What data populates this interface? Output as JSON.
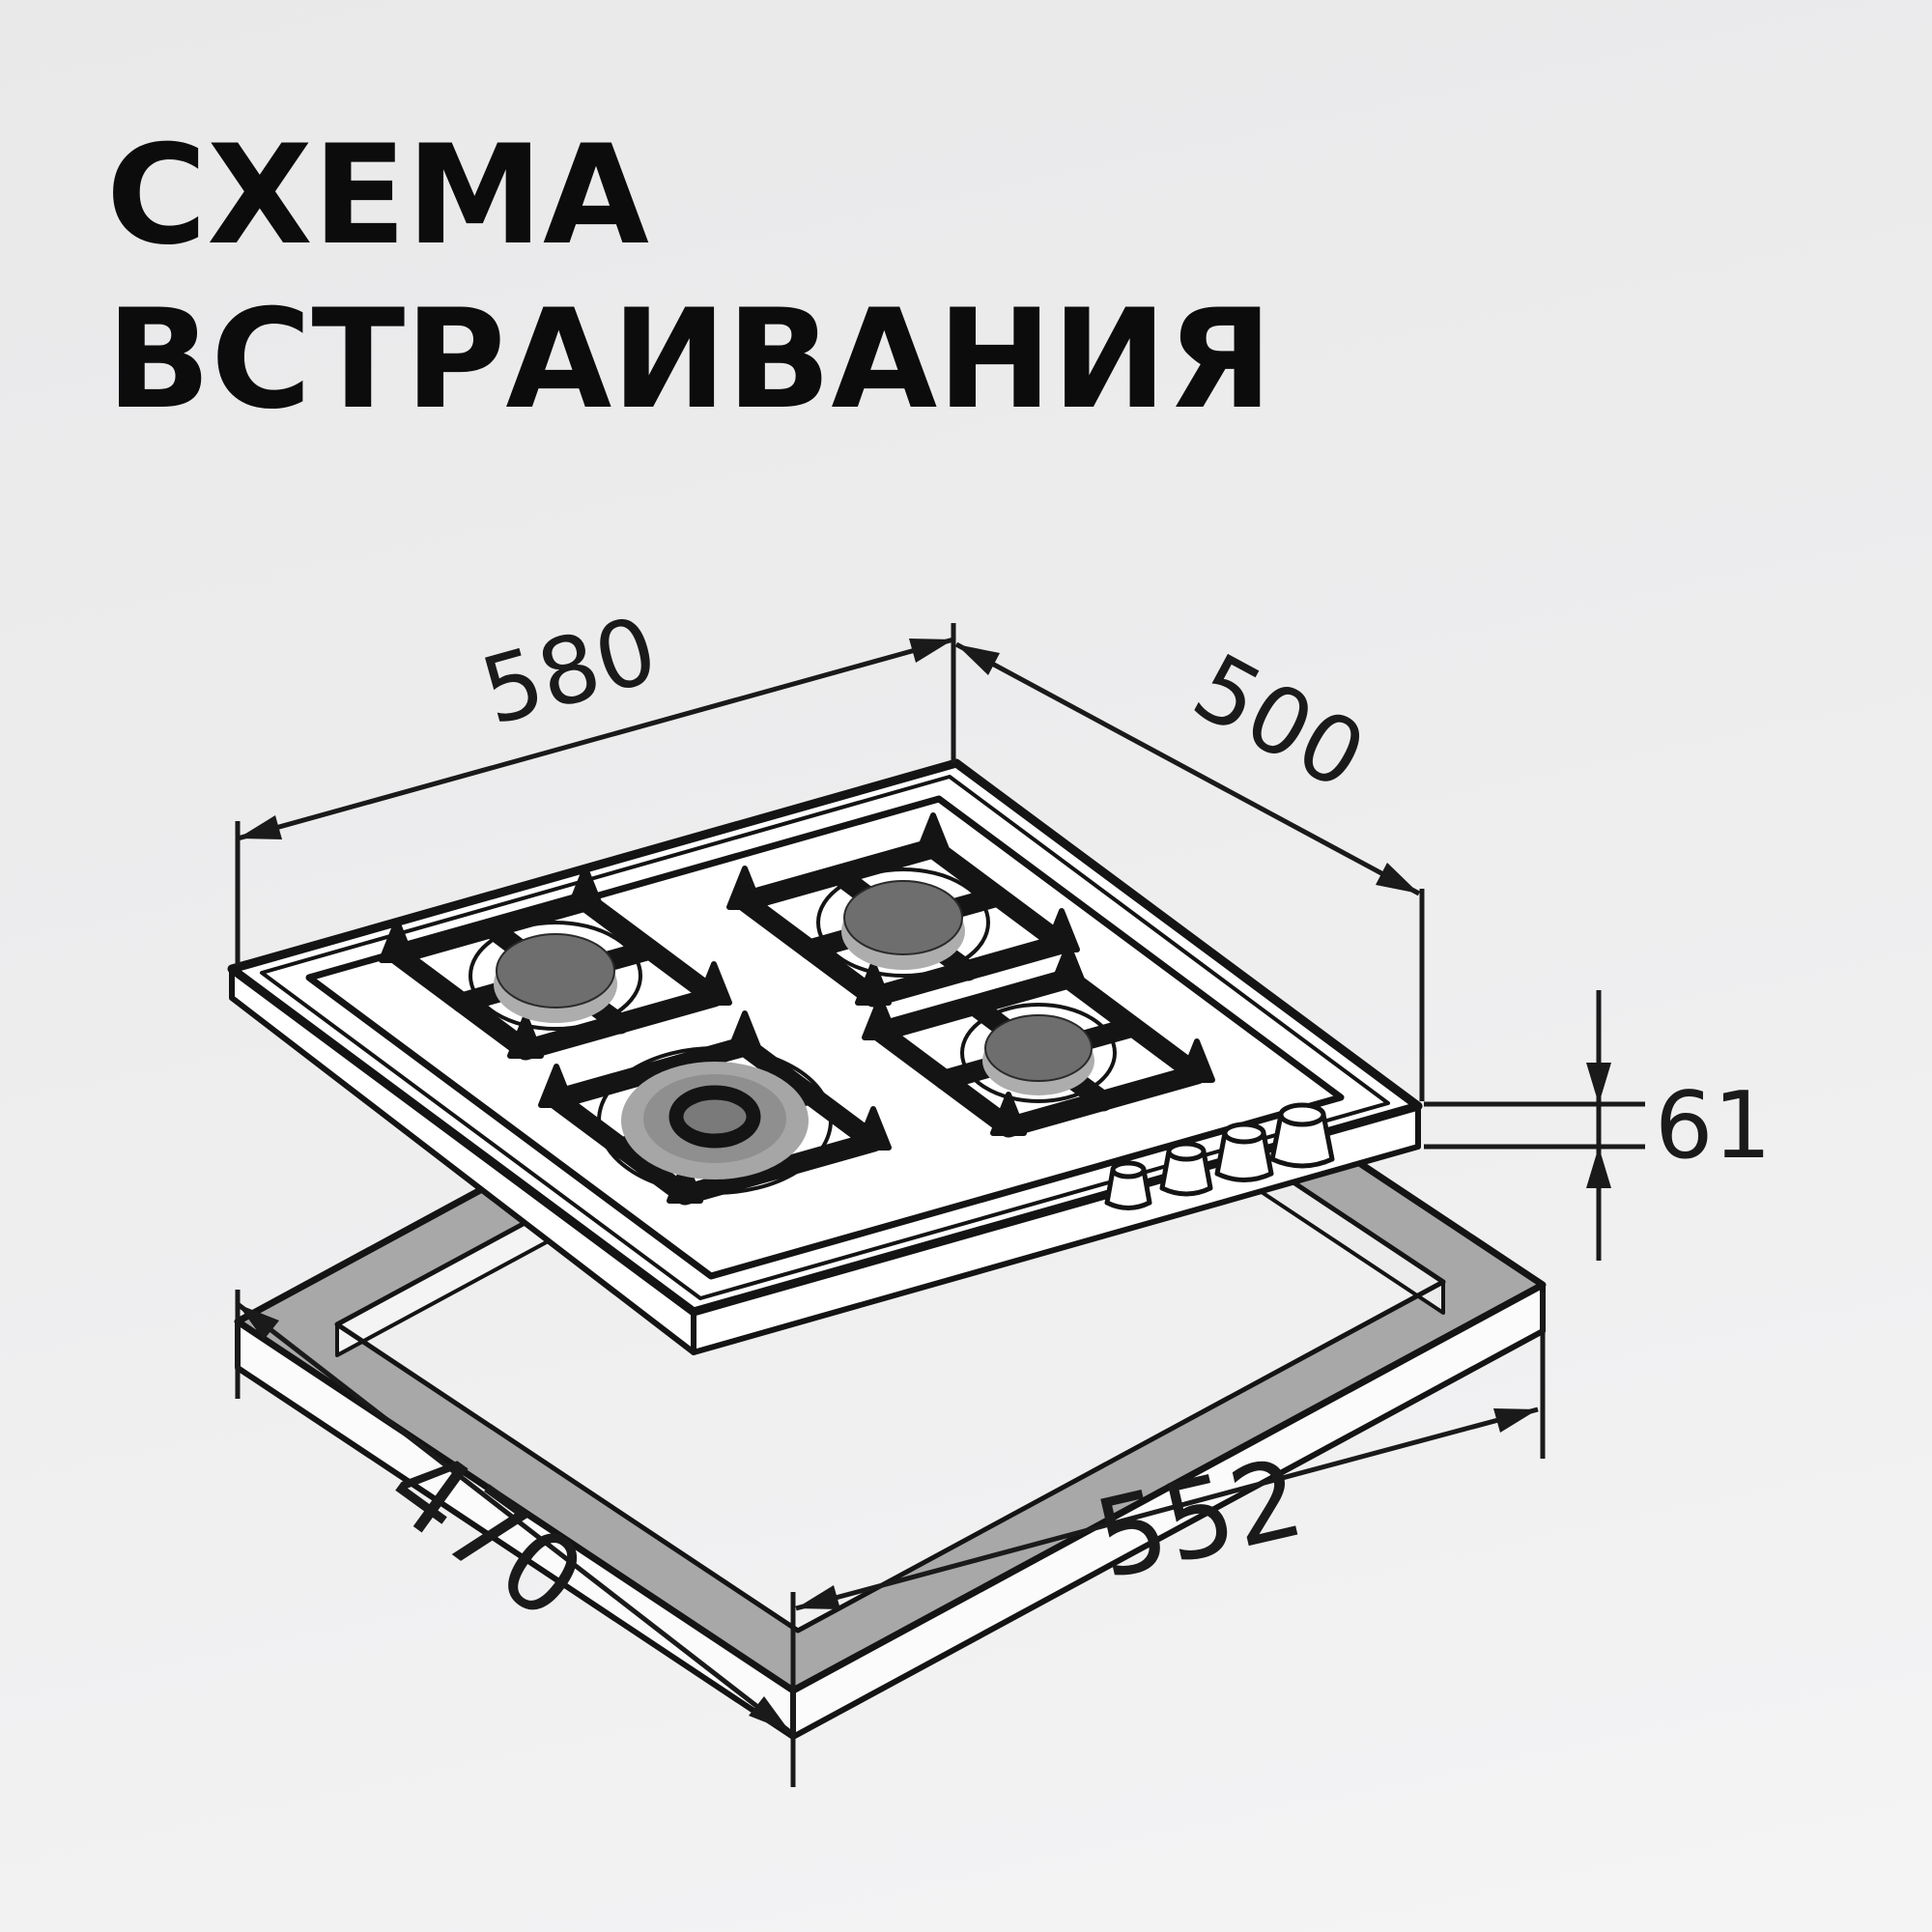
{
  "page": {
    "background_top": "#e9e9ea",
    "background_bottom": "#f4f4f5",
    "line_color": "#141414",
    "cutout_surface_color": "#a8a8a8",
    "burner_cap_color": "#6e6e6e"
  },
  "title": {
    "line1": "СХЕМА",
    "line2": "ВСТРАИВАНИЯ"
  },
  "diagram": {
    "kind": "built-in gas hob installation scheme",
    "hob": {
      "burner_count": 4,
      "knob_count": 4
    },
    "dimensions": {
      "hob_width": "580",
      "hob_depth": "500",
      "hob_height": "61",
      "cutout_depth": "470",
      "cutout_width": "552"
    }
  }
}
